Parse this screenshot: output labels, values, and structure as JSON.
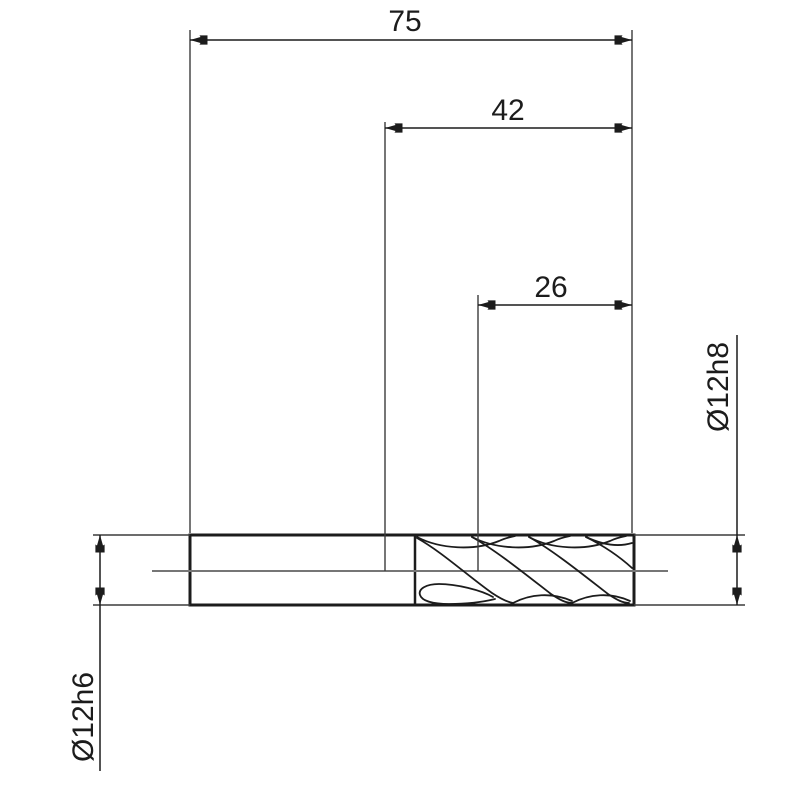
{
  "drawing": {
    "kind": "technical-drawing",
    "dimensions": {
      "overall_length": "75",
      "intermediate_length": "42",
      "flute_length": "26",
      "flute_diameter": "Ø12h8",
      "shank_diameter": "Ø12h6"
    },
    "colors": {
      "line": "#1c1c1c",
      "thin_line": "#3c3c3c",
      "centerline": "#767676",
      "background": "#ffffff"
    }
  }
}
